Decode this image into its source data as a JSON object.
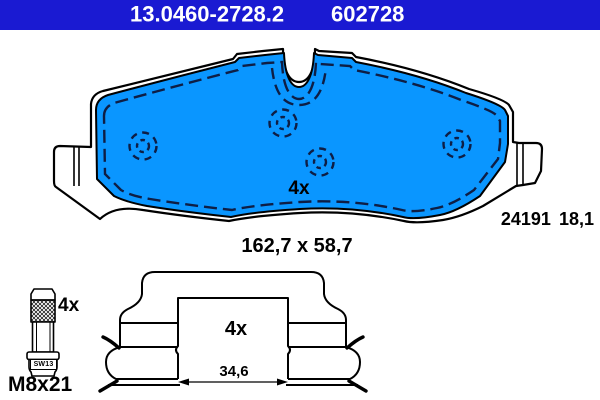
{
  "header": {
    "catalog_number": "13.0460-2728.2",
    "article_number": "602728",
    "bg_color": "#1A1AD2",
    "text_color": "#FFFFFF"
  },
  "pad": {
    "quantity_label": "4x",
    "dimensions_label": "162,7 x 58,7",
    "wva_number": "24191",
    "thickness": "18,1",
    "fill_color": "#0A96FF"
  },
  "bolt": {
    "quantity_label": "4x",
    "thread_label": "M8x21",
    "head_label": "SW13"
  },
  "clip": {
    "quantity_label": "4x",
    "width_label": "34,6"
  }
}
